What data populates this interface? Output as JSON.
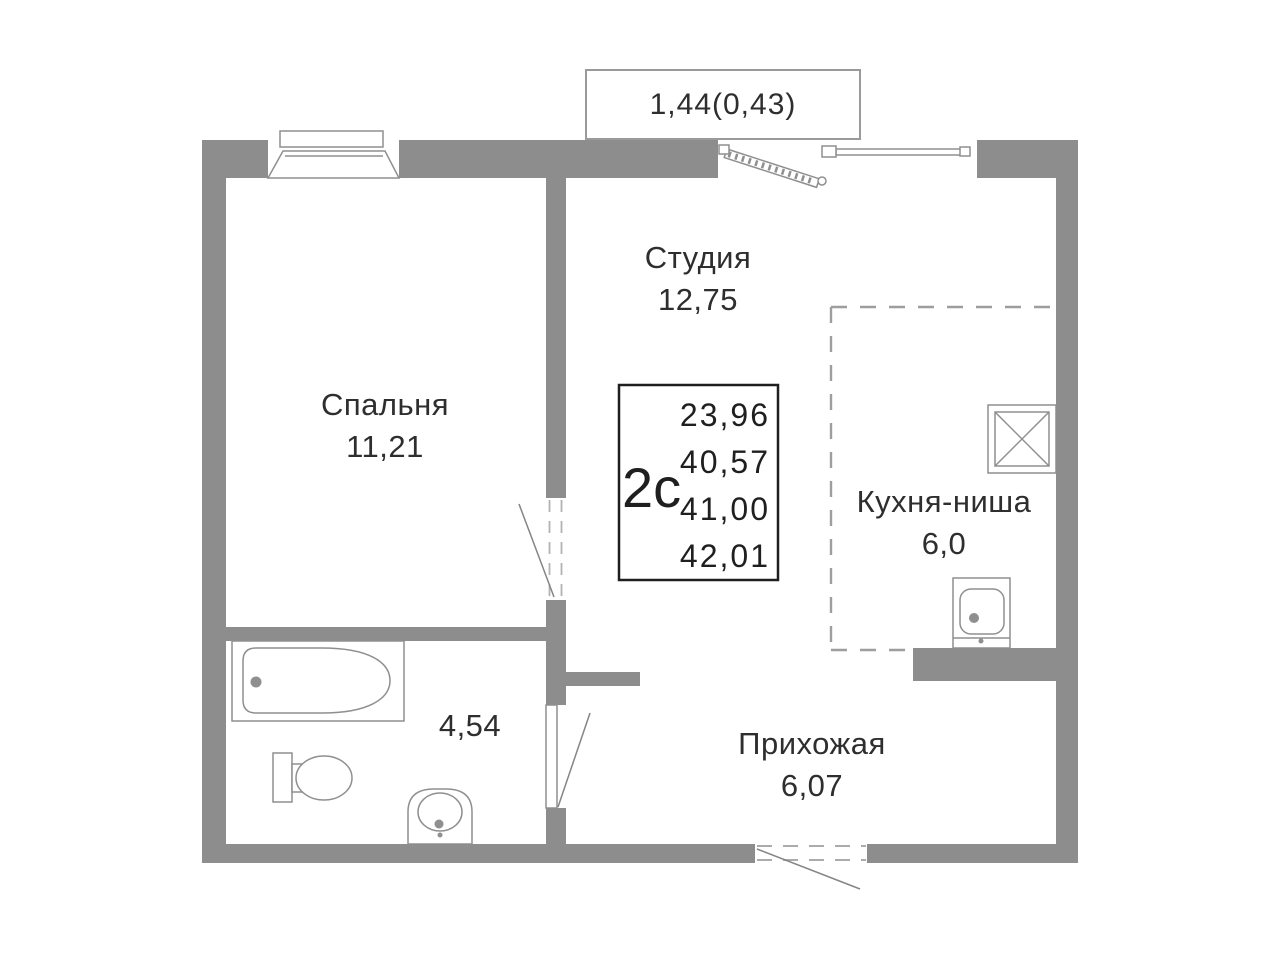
{
  "plan": {
    "balcony": {
      "label": "1,44(0,43)"
    },
    "info_box": {
      "type": "2с",
      "areas": [
        "23,96",
        "40,57",
        "41,00",
        "42,01"
      ]
    },
    "rooms": {
      "bedroom": {
        "name": "Спальня",
        "area": "11,21"
      },
      "studio": {
        "name": "Студия",
        "area": "12,75"
      },
      "kitchen": {
        "name": "Кухня-ниша",
        "area": "6,0"
      },
      "hallway": {
        "name": "Прихожая",
        "area": "6,07"
      },
      "bathroom": {
        "area": "4,54"
      }
    },
    "colors": {
      "wall": "#8d8d8d",
      "line": "#8f8f8f",
      "dash": "#9e9e9e",
      "text": "#2e2e2e",
      "info_border": "#1f1f1f"
    }
  }
}
